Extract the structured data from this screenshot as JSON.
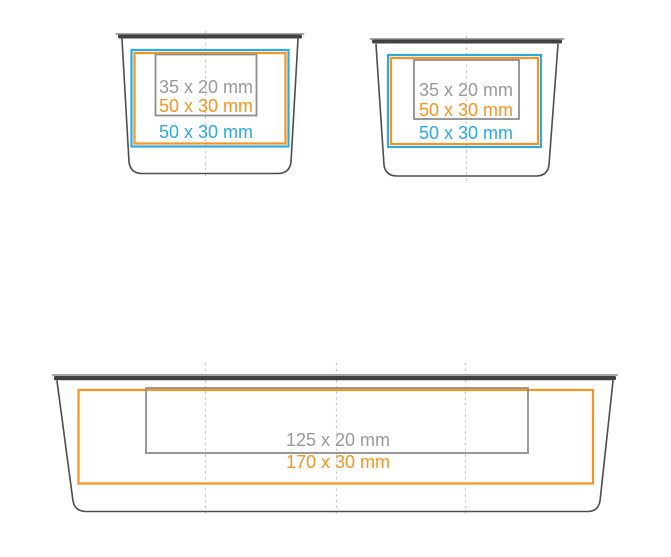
{
  "page": {
    "background": "#ffffff",
    "description": "Print area diagram for two small cups and one large tray"
  },
  "colors": {
    "blue": "#29abe2",
    "orange": "#f7931e",
    "gray_label": "#999999",
    "gray_rect": "#8e8e8e",
    "outline": "#4d4d4d",
    "rim_dark": "#414042",
    "rim_light": "#a5a5a5",
    "dash": "#c9c9c9"
  },
  "containers": [
    {
      "name": "small-cup-left",
      "labels": [
        {
          "text": "35 x 20 mm",
          "role": "gray-inner-area"
        },
        {
          "text": "50 x 30 mm",
          "role": "orange-print-area"
        },
        {
          "text": "50 x 30 mm",
          "role": "blue-print-area"
        }
      ]
    },
    {
      "name": "small-cup-right",
      "labels": [
        {
          "text": "35 x 20 mm",
          "role": "gray-inner-area"
        },
        {
          "text": "50 x 30 mm",
          "role": "orange-print-area"
        },
        {
          "text": "50 x 30 mm",
          "role": "blue-print-area"
        }
      ]
    },
    {
      "name": "large-tray",
      "labels": [
        {
          "text": "125 x 20 mm",
          "role": "gray-inner-area"
        },
        {
          "text": "170 x 30 mm",
          "role": "orange-print-area"
        }
      ]
    }
  ]
}
